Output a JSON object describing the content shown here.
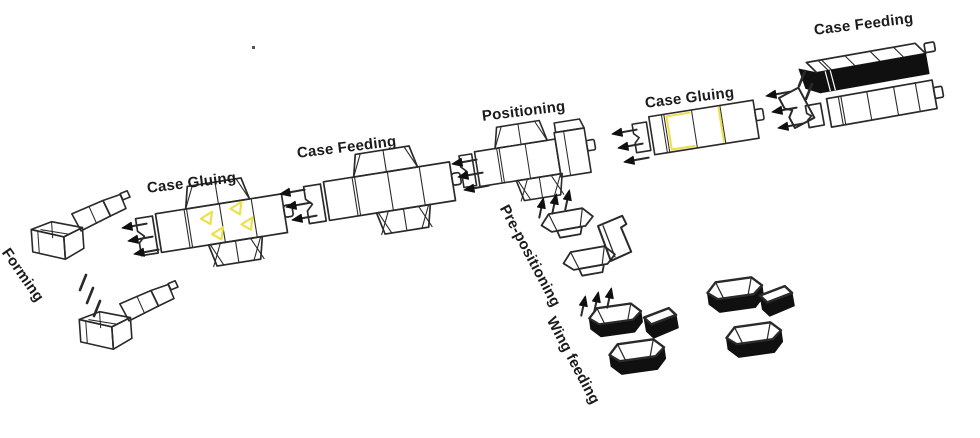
{
  "stations": [
    {
      "id": "case-feeding-top-right",
      "label": "Case Feeding"
    },
    {
      "id": "case-gluing-right",
      "label": "Case Gluing"
    },
    {
      "id": "positioning",
      "label": "Positioning"
    },
    {
      "id": "case-feeding-middle",
      "label": "Case Feeding"
    },
    {
      "id": "case-gluing-left",
      "label": "Case Gluing"
    },
    {
      "id": "forming",
      "label": "Forming"
    },
    {
      "id": "pre-positioning",
      "label": "Pre-positioning"
    },
    {
      "id": "wing-feeding",
      "label": "Wing feeding"
    }
  ],
  "icons": {
    "flow-arrow-left": "leftward flow arrow",
    "flow-arrow-up": "upward flow arrow",
    "motion-slash": "motion slash mark"
  },
  "colors": {
    "line": "#2a2a2a",
    "dark_fill": "#101010",
    "glue_highlight": "#ece14d",
    "background": "#ffffff",
    "text": "#1b1b1b"
  }
}
